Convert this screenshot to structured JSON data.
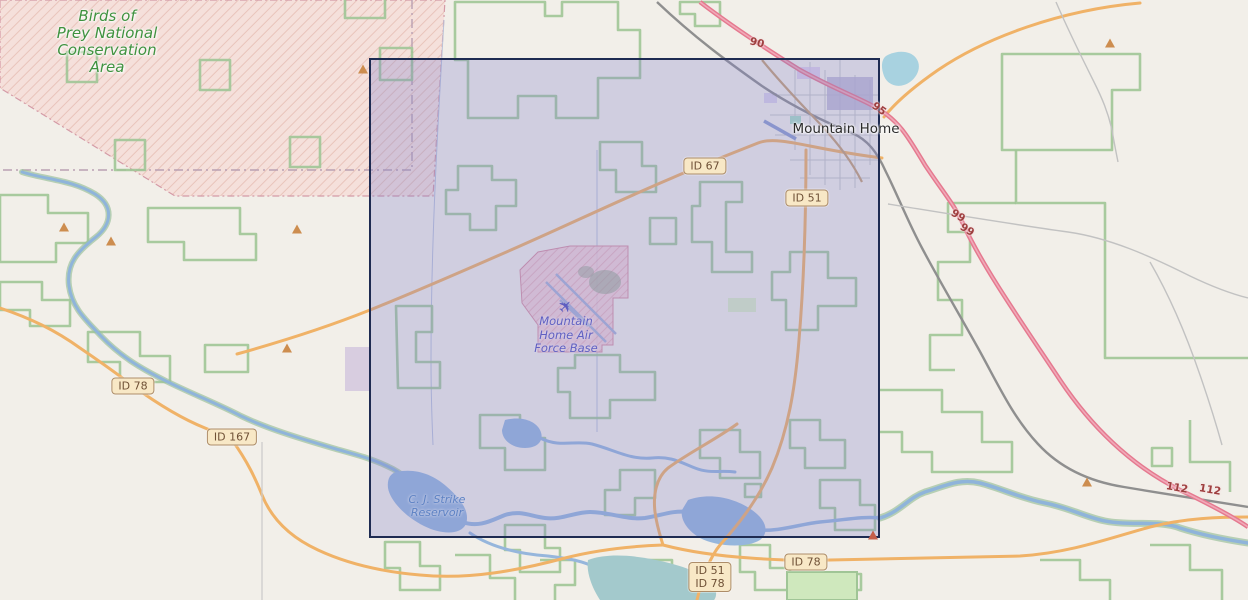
{
  "map": {
    "labels": {
      "conservation_area_lines": [
        "Birds of",
        "Prey National",
        "Conservation",
        "Area"
      ],
      "city": "Mountain Home",
      "air_force_base_lines": [
        "Mountain",
        "Home Air",
        "Force Base"
      ],
      "reservoir_lines": [
        "C. J. Strike",
        "Reservoir"
      ]
    },
    "shields": [
      {
        "label": "ID 67"
      },
      {
        "label": "ID 51"
      },
      {
        "label": "ID 78"
      },
      {
        "label": "ID 167"
      },
      {
        "label": "ID 78"
      }
    ],
    "stacked_shield": {
      "lines": [
        "ID 51",
        "ID 78"
      ]
    },
    "route_numbers": [
      "90",
      "95",
      "99",
      "99",
      "112",
      "112"
    ],
    "icons": {
      "airplane": "✈"
    },
    "colors": {
      "background": "#f2efe9",
      "selection_fill": "rgba(128,128,204,0.30)",
      "selection_border": "#1e2b52",
      "conservation_fill": "#f5ddd8",
      "conservation_hatch": "#e4b7af",
      "afb_fill": "#f2ccd2",
      "boundary_green": "#a0c596",
      "water_blue": "#a6c3e2",
      "water_teal": "#a3c9cc",
      "lake_cyan": "#a8d2e0",
      "road_orange": "#f0b267",
      "motorway_pink": "#e5798f",
      "road_gray": "#9b9b9b",
      "shield_bg": "#f8e8c6",
      "shield_border": "#ad8d69",
      "shield_text": "#6f5136",
      "route_number_text": "#9e3f3f",
      "conservation_text": "#3f923f",
      "afb_text": "#6060c2",
      "water_text": "#5d82c4",
      "city_text": "#2b2b2b",
      "peak_orange": "#cd8d4f"
    }
  }
}
